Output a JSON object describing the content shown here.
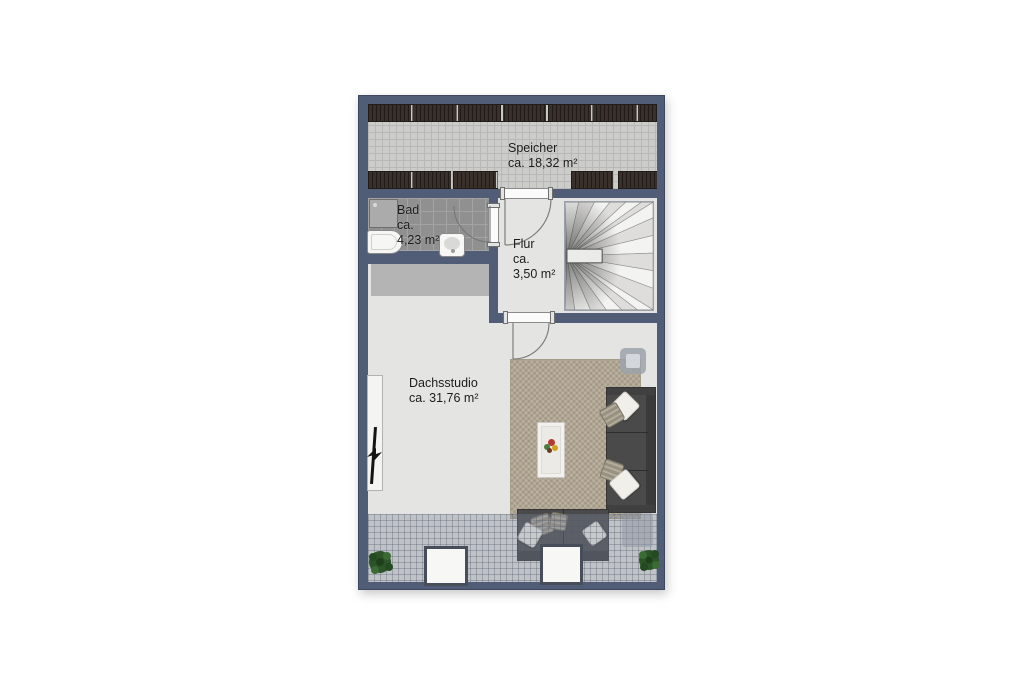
{
  "floorplan": {
    "rooms": {
      "speicher": {
        "name": "Speicher",
        "area": "ca. 18,32 m²"
      },
      "bad": {
        "name": "Bad",
        "approx": "ca.",
        "area": "4,23 m²"
      },
      "flur": {
        "name": "Flur",
        "approx": "ca.",
        "area": "3,50 m²"
      },
      "dachsstudio": {
        "name": "Dachsstudio",
        "area": "ca. 31,76 m²"
      }
    },
    "furniture": [
      "winder-staircase",
      "stair-handrail",
      "shower",
      "bathtub",
      "sink",
      "tv-lowboard",
      "tv",
      "rug",
      "coffee-table",
      "flower-decoration",
      "sofa-vertical",
      "sofa-horizontal",
      "pillows",
      "ottoman",
      "side-block",
      "skylight-window",
      "skylight-window",
      "plant",
      "plant"
    ],
    "colors": {
      "wall": "#515c77",
      "floor": "#e4e4e2",
      "speicher-floor": "#cccccb",
      "beam": "#3a302b",
      "tile": "#909090",
      "band": "#b4b4b4",
      "rug": "#b1a692",
      "sofa": "#4a4a4a",
      "plant": "#2d5429",
      "skylight-frame": "#474e5a"
    }
  }
}
